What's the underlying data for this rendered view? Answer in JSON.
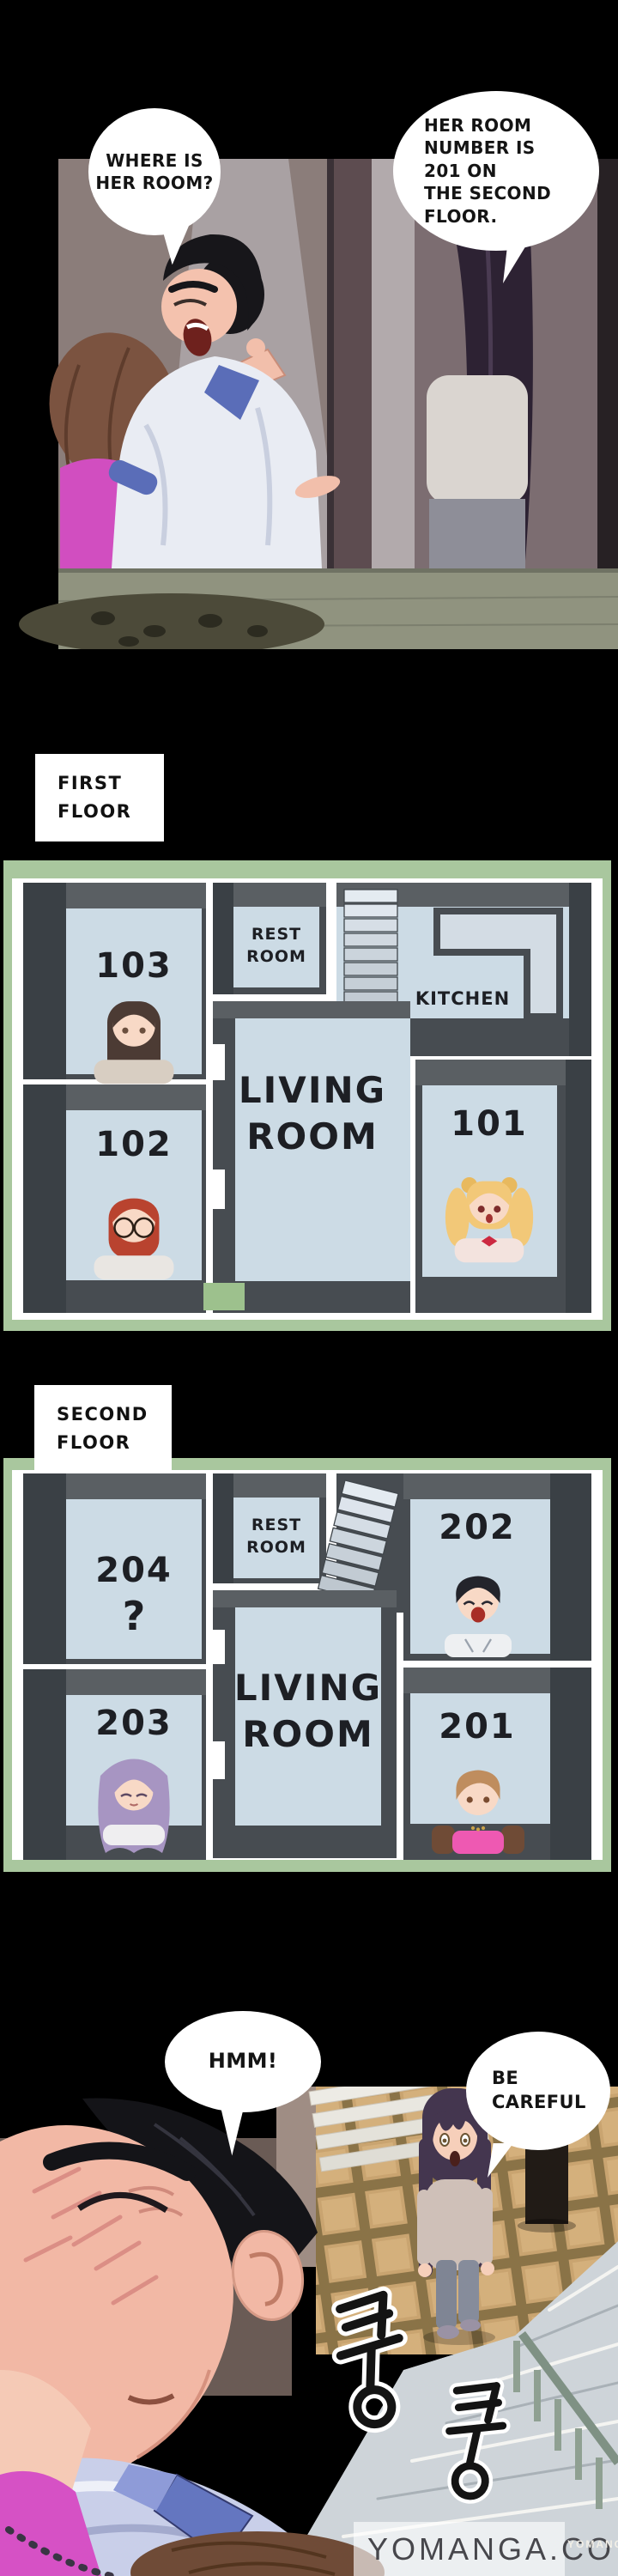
{
  "panel_top": {
    "bubble_where": {
      "lines": [
        "WHERE IS",
        "HER ROOM?"
      ]
    },
    "bubble_room_number": {
      "lines": [
        "HER ROOM",
        "NUMBER IS",
        "201 ON",
        "THE SECOND",
        "FLOOR."
      ]
    }
  },
  "section_labels": {
    "first_floor": {
      "lines": [
        "FIRST",
        "FLOOR"
      ]
    },
    "second_floor": {
      "lines": [
        "SECOND",
        "FLOOR"
      ]
    }
  },
  "floor1": {
    "rooms": {
      "r103": "103",
      "r102": "102",
      "r101": "101"
    },
    "rest_room": {
      "lines": [
        "REST",
        "ROOM"
      ]
    },
    "living_room": {
      "lines": [
        "LIVING",
        "ROOM"
      ]
    },
    "kitchen": "KITCHEN"
  },
  "floor2": {
    "rooms": {
      "r204": "204",
      "r204_unknown": "?",
      "r203": "203",
      "r202": "202",
      "r201": "201"
    },
    "rest_room": {
      "lines": [
        "REST",
        "ROOM"
      ]
    },
    "living_room": {
      "lines": [
        "LIVING",
        "ROOM"
      ]
    }
  },
  "panel_bottom": {
    "bubble_hmm": {
      "lines": [
        "HMM!"
      ]
    },
    "bubble_careful": {
      "lines": [
        "BE",
        "CAREFUL"
      ]
    },
    "sfx_thud_1": "쿵",
    "sfx_thud_2": "쿵",
    "watermark": "YOMANGA.CO",
    "watermark_small": "YOMANGA"
  },
  "colors": {
    "plan_frame_green": "#a9c79e",
    "plan_room_floor": "#ccdbe5",
    "plan_wall": "#474c51",
    "accent_pink": "#d651c5"
  }
}
